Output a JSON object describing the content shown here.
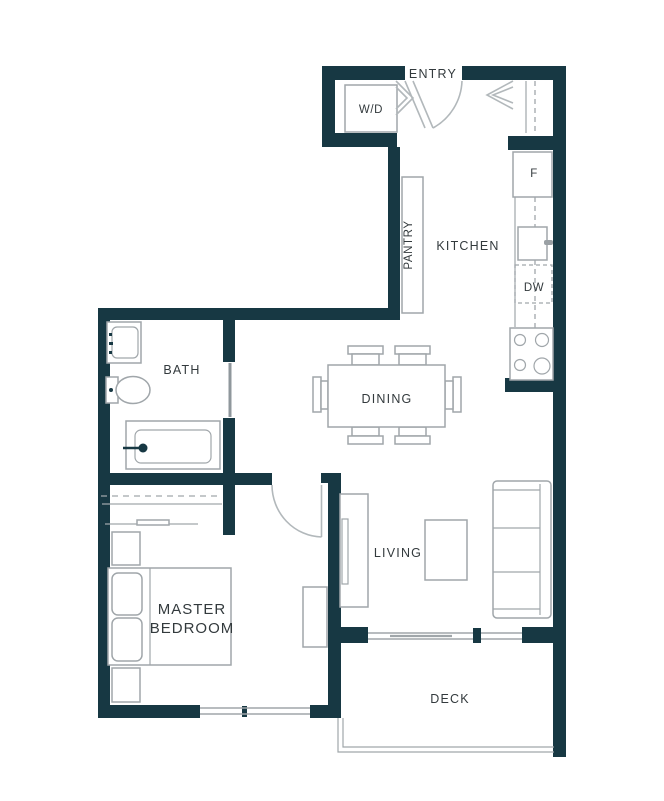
{
  "rooms": {
    "entry": "ENTRY",
    "kitchen": "KITCHEN",
    "pantry": "PANTRY",
    "bath": "BATH",
    "dining": "DINING",
    "living": "LIVING",
    "master_line1": "MASTER",
    "master_line2": "BEDROOM",
    "deck": "DECK"
  },
  "appliances": {
    "washer_dryer": "W/D",
    "fridge": "F",
    "dishwasher": "DW"
  },
  "colors": {
    "wall": "#173843",
    "line": "#a0a6aa",
    "leaf": "#b2b8bb",
    "text": "#333a3d"
  }
}
